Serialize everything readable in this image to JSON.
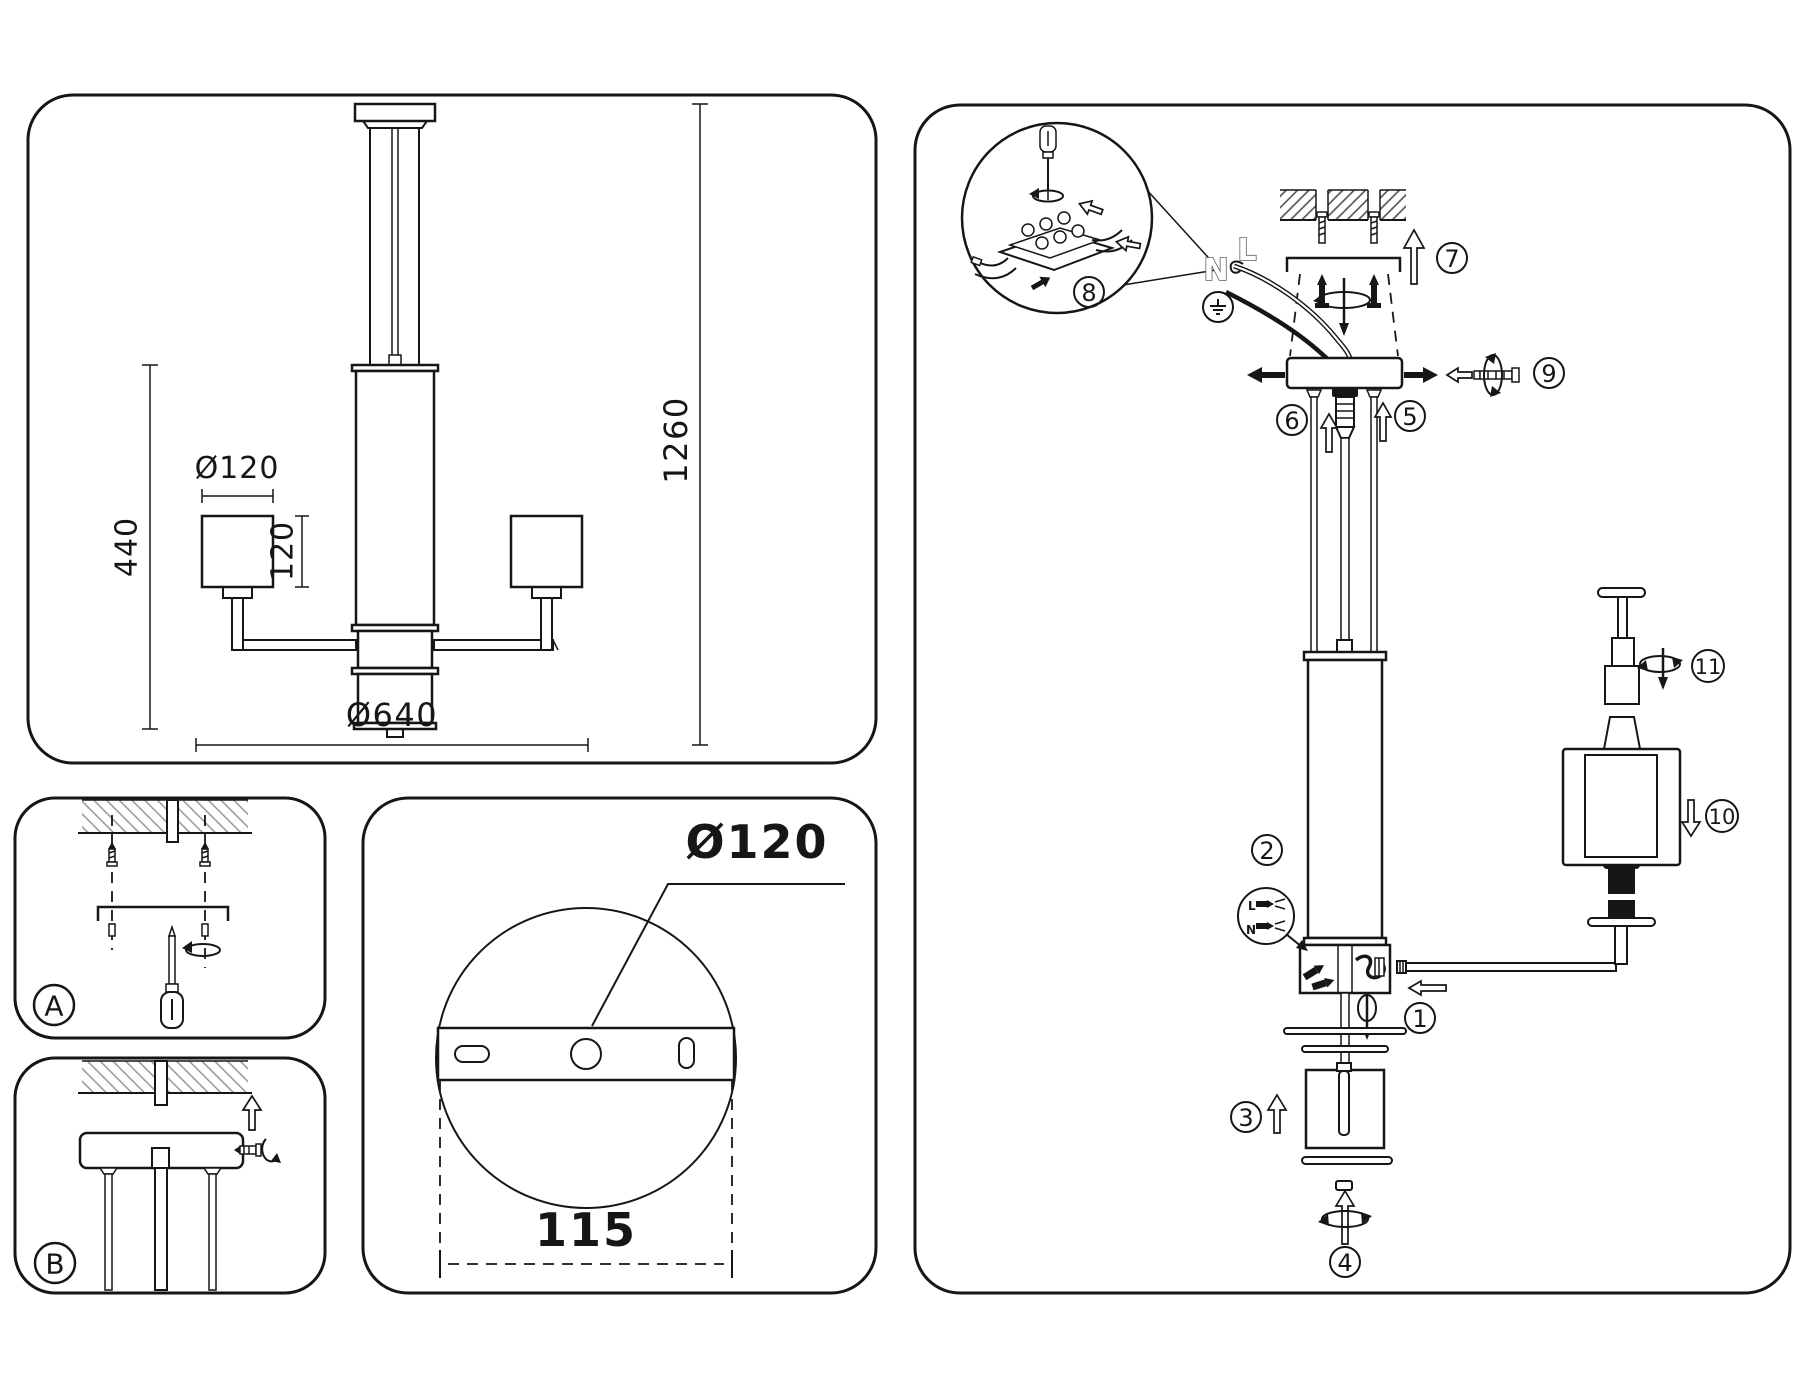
{
  "colors": {
    "ink": "#161616",
    "paper": "#ffffff",
    "hatch_light": "#8f8f8f",
    "hatch_dark": "#4f4f4f"
  },
  "overview": {
    "dims": {
      "shade_diameter": "Ø120",
      "shade_height": "120",
      "section_height": "440",
      "total_height": "1260",
      "total_width": "Ø640"
    }
  },
  "mount": {
    "step_a": "A",
    "step_b": "B"
  },
  "plate": {
    "diameter": "Ø120",
    "pitch": "115"
  },
  "assembly": {
    "wire_live": "L",
    "wire_neutral": "N",
    "detail_live": "L",
    "detail_neutral": "N",
    "steps": [
      {
        "n": "1"
      },
      {
        "n": "2"
      },
      {
        "n": "3"
      },
      {
        "n": "4"
      },
      {
        "n": "5"
      },
      {
        "n": "6"
      },
      {
        "n": "7"
      },
      {
        "n": "8"
      },
      {
        "n": "9"
      },
      {
        "n": "10"
      },
      {
        "n": "11"
      }
    ]
  }
}
